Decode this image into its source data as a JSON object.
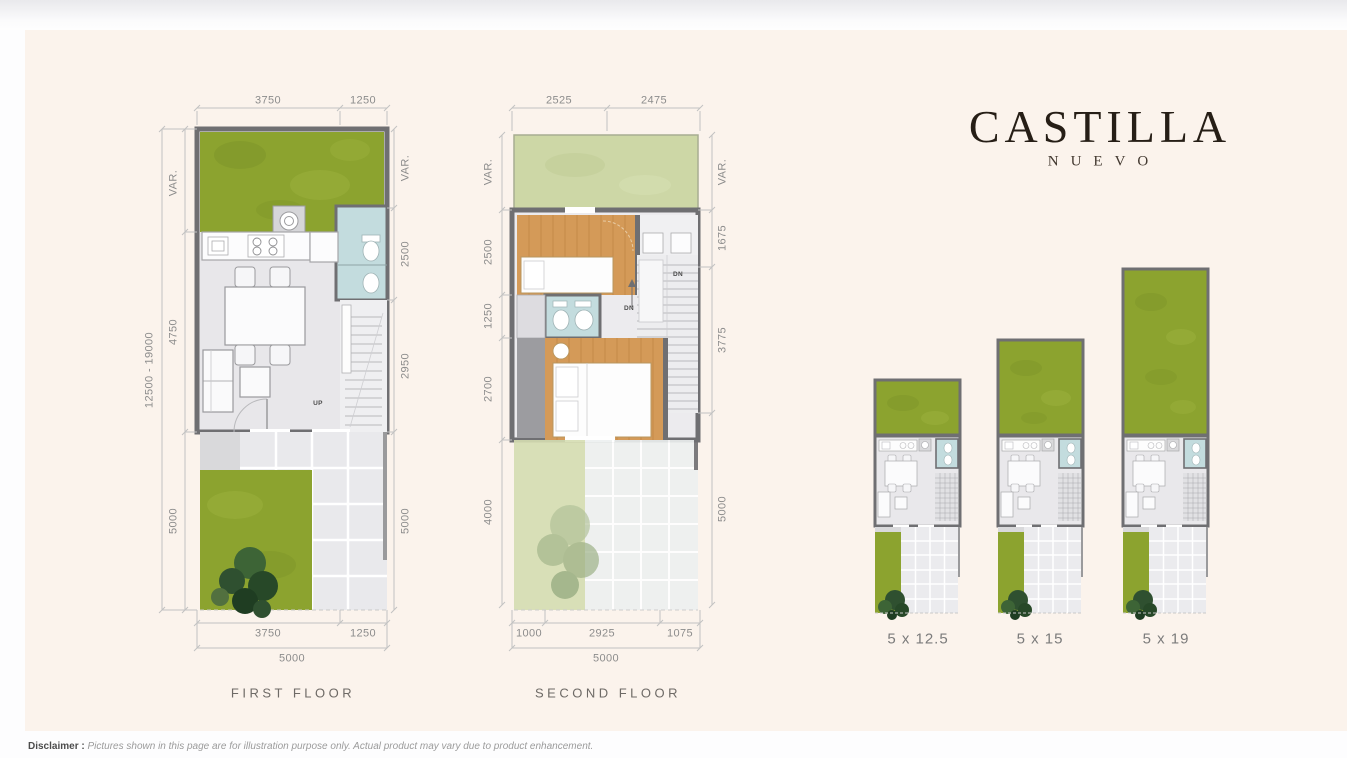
{
  "logo": {
    "title": "CASTILLA",
    "subtitle": "NUEVO"
  },
  "floor_plans": {
    "first_floor": {
      "label": "FIRST FLOOR",
      "dim_top": [
        "3750",
        "1250"
      ],
      "dim_left_outer": "12500 - 19000",
      "dim_left": [
        "VAR.",
        "4750",
        "5000"
      ],
      "dim_right": [
        "VAR.",
        "2500",
        "2950",
        "5000"
      ],
      "dim_bottom": [
        "3750",
        "1250"
      ],
      "dim_bottom_total": "5000",
      "stair_label": "UP"
    },
    "second_floor": {
      "label": "SECOND FLOOR",
      "dim_top": [
        "2525",
        "2475"
      ],
      "dim_left": [
        "VAR.",
        "2500",
        "1250",
        "2700",
        "4000"
      ],
      "dim_right": [
        "VAR.",
        "1675",
        "3775",
        "5000"
      ],
      "dim_bottom": [
        "1000",
        "2925",
        "1075"
      ],
      "dim_bottom_total": "5000",
      "stair_label_1": "DN",
      "stair_label_2": "DN"
    }
  },
  "variants": {
    "items": [
      {
        "label": "5 x 12.5"
      },
      {
        "label": "5 x 15"
      },
      {
        "label": "5 x 19"
      }
    ]
  },
  "disclaimer": {
    "label": "Disclaimer :",
    "text": "Pictures shown in this page are for illustration purpose only. Actual product may vary due to product enhancement."
  },
  "colors": {
    "panel_background": "#fbf3ec",
    "garden_green": "#8ca32f",
    "roof_garden_green": "#cdd7a6",
    "wall_gray": "#6f6f72",
    "bathroom_blue": "#c3dcde",
    "wood_floor": "#d49a58",
    "tile_gray": "#e9e9ec",
    "dimension_text": "#8c8c8c",
    "logo_text": "#261e16"
  }
}
